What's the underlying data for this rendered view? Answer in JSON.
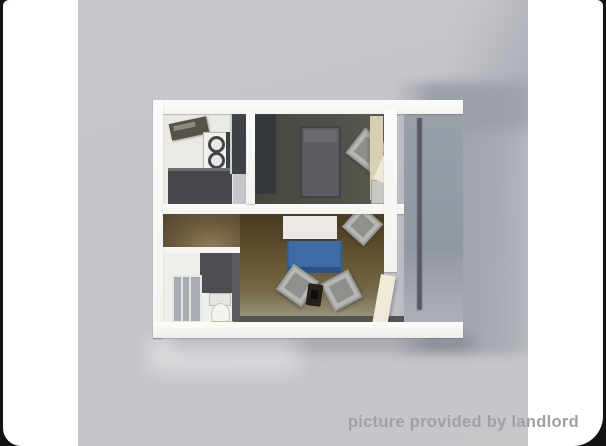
{
  "window": {
    "description": "3D rendered bird's-eye floor plan of a one-bedroom apartment shown inside a white rounded card on a black letterboxed background",
    "watermark": "picture provided by landlord"
  },
  "colors": {
    "frame-bg": "#141414",
    "card-bg": "#ffffff",
    "photo-bg": "#c4c4c9",
    "wall": "#f3f3f0",
    "kitchen-floor": "#ebe9e3",
    "bedroom-floor": "#46463f",
    "hall-floor": "#6a5a3c",
    "living-floor": "#62522f",
    "balcony-floor": "#9aa0a9",
    "bed": "#5a5c61",
    "chair": "#b6b6b3",
    "sofa": "#3e6ba6",
    "table": "#eae9e5",
    "wardrobe-tan": "#d7ceb4",
    "wardrobe-dark": "#34373b",
    "stove": "#f1f0ed",
    "counter": "#46484d",
    "bath-dark": "#4c4e53",
    "shower": "#a9adb3",
    "toilet": "#f3f3f0",
    "mat": "#e5ddba",
    "door": "#efe9d7",
    "watermark": "#a0a1a6"
  },
  "scene": {
    "rooms": [
      {
        "name": "kitchen",
        "position": "top-left"
      },
      {
        "name": "bedroom",
        "position": "top-right"
      },
      {
        "name": "bathroom",
        "position": "bottom-left"
      },
      {
        "name": "living-room",
        "position": "bottom-center"
      },
      {
        "name": "balcony-entry",
        "position": "right"
      }
    ],
    "furniture": [
      "sink",
      "stove",
      "counter",
      "fridge",
      "bed",
      "bedroom-chair",
      "wardrobe",
      "nightstand",
      "table",
      "sofa",
      "chair",
      "chair",
      "chair",
      "plant",
      "shower",
      "toilet",
      "bath-mat",
      "open-door"
    ]
  }
}
